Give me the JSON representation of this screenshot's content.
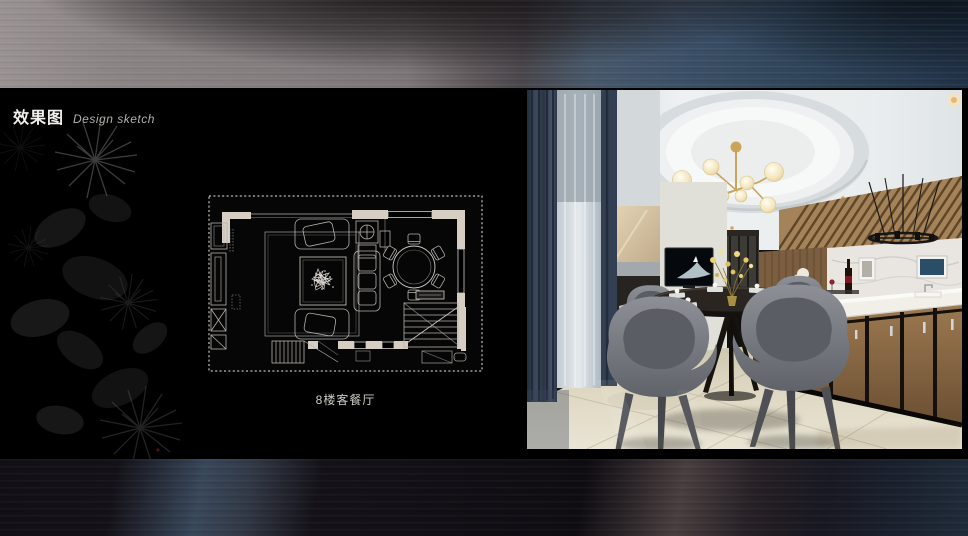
{
  "header": {
    "title_cn": "效果图",
    "title_en": "Design sketch"
  },
  "floorplan": {
    "caption": "8楼客餐厅"
  },
  "colors": {
    "background": "#000000",
    "top_band_left": "#8b8485",
    "top_band_right": "#2c4157",
    "accent_gold": "#c9a45a",
    "curtain_navy": "#36415a",
    "wall_beige": "#d6cec2",
    "plan_line": "#b4b1aa",
    "chair_gray": "#76797f",
    "cabinet_wood": "#8a6a48",
    "floor_beige": "#ddd6c0"
  }
}
